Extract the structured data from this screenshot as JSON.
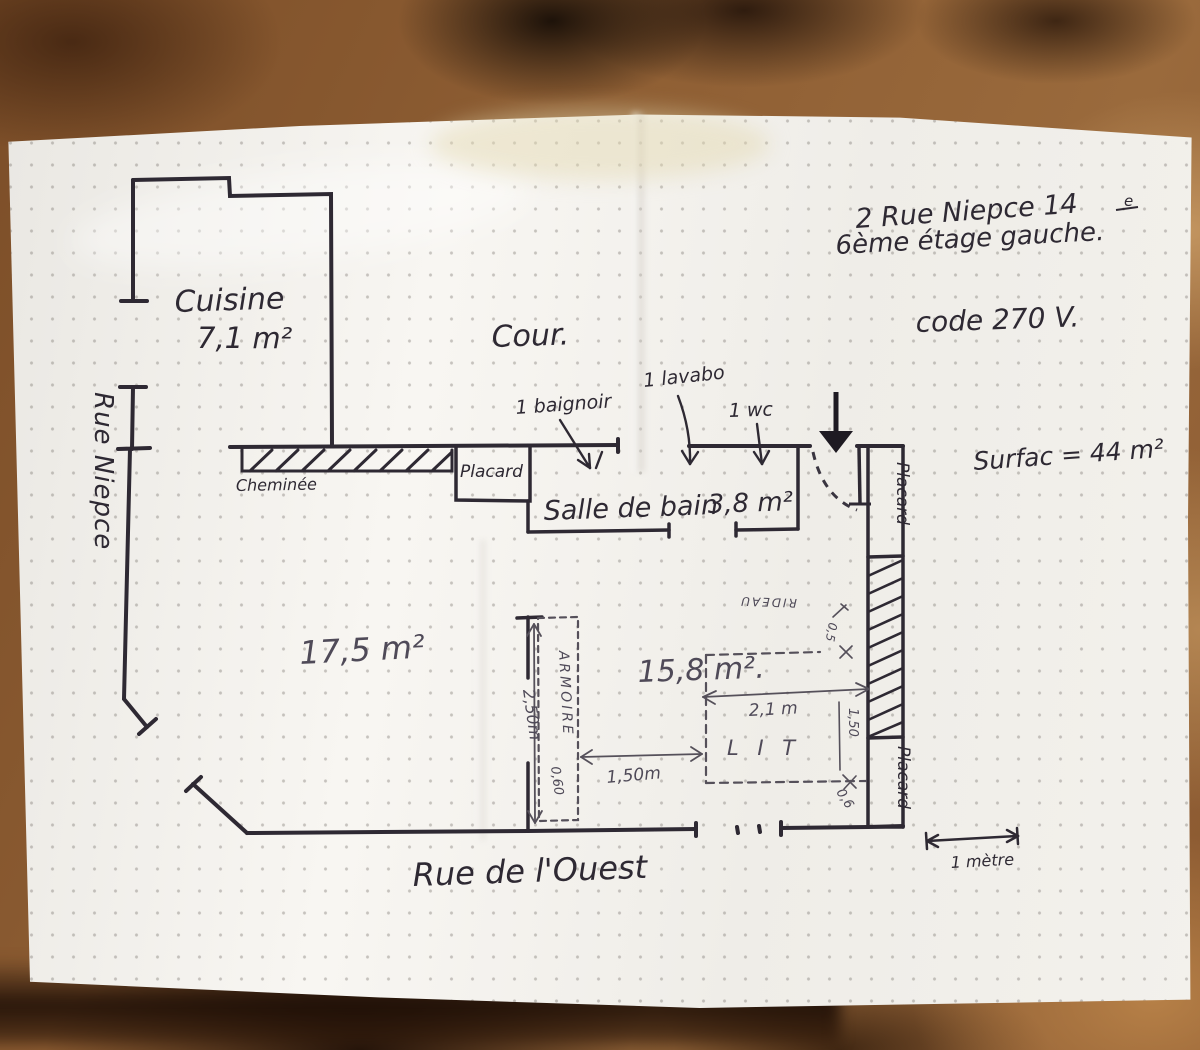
{
  "notes": {
    "address": "2 Rue Niepce 14",
    "address_sup": "e",
    "floor": "6ème étage gauche.",
    "code": "code 270 V.",
    "surface": "Surfac = 44 m²"
  },
  "streets": {
    "left": "Rue Niepce",
    "bottom": "Rue de l'Ouest",
    "courtyard": "Cour."
  },
  "rooms": {
    "kitchen_name": "Cuisine",
    "kitchen_area": "7,1 m²",
    "bathroom_name": "Salle de bain",
    "bathroom_area": "3,8 m²",
    "living_area": "17,5 m²",
    "bedroom_area": "15,8 m²."
  },
  "fixtures": {
    "bath": "1 baignoir",
    "sink": "1 lavabo",
    "wc": "1 wc",
    "chimney": "Cheminée",
    "closet_top": "Placard",
    "closet_right_top": "Placard",
    "closet_right_bottom": "Placard",
    "wardrobe": "ARMOIRE",
    "bed": "L I T",
    "curtain": "RIDEAU"
  },
  "dimensions": {
    "wardrobe_length": "2,50m",
    "wardrobe_depth": "0,60",
    "gap_armoire_bed": "1,50m",
    "bed_width": "2,1 m",
    "bed_length": "1,50",
    "bed_to_wall": "0,6",
    "curtain_depth": "0,5",
    "scale_label": "1 mètre"
  }
}
